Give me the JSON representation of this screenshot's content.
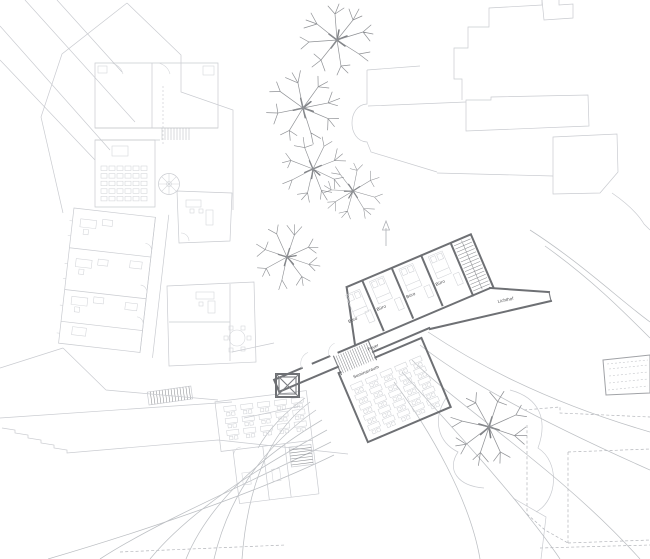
{
  "plan": {
    "labels": {
      "office": "Büro",
      "foyer": "Foyer",
      "seminar_room": "Seminarraum",
      "atrium": "Lichthof"
    },
    "colors": {
      "background": "#ffffff",
      "new_building_wall": "#6e7074",
      "existing_building_line": "#c9cbd0",
      "contour_line": "#bcbfc3",
      "tree_line": "#8f9195",
      "label_text": "#4a4b4e"
    },
    "legend": {
      "drawing_type": "site-floor-plan"
    }
  }
}
